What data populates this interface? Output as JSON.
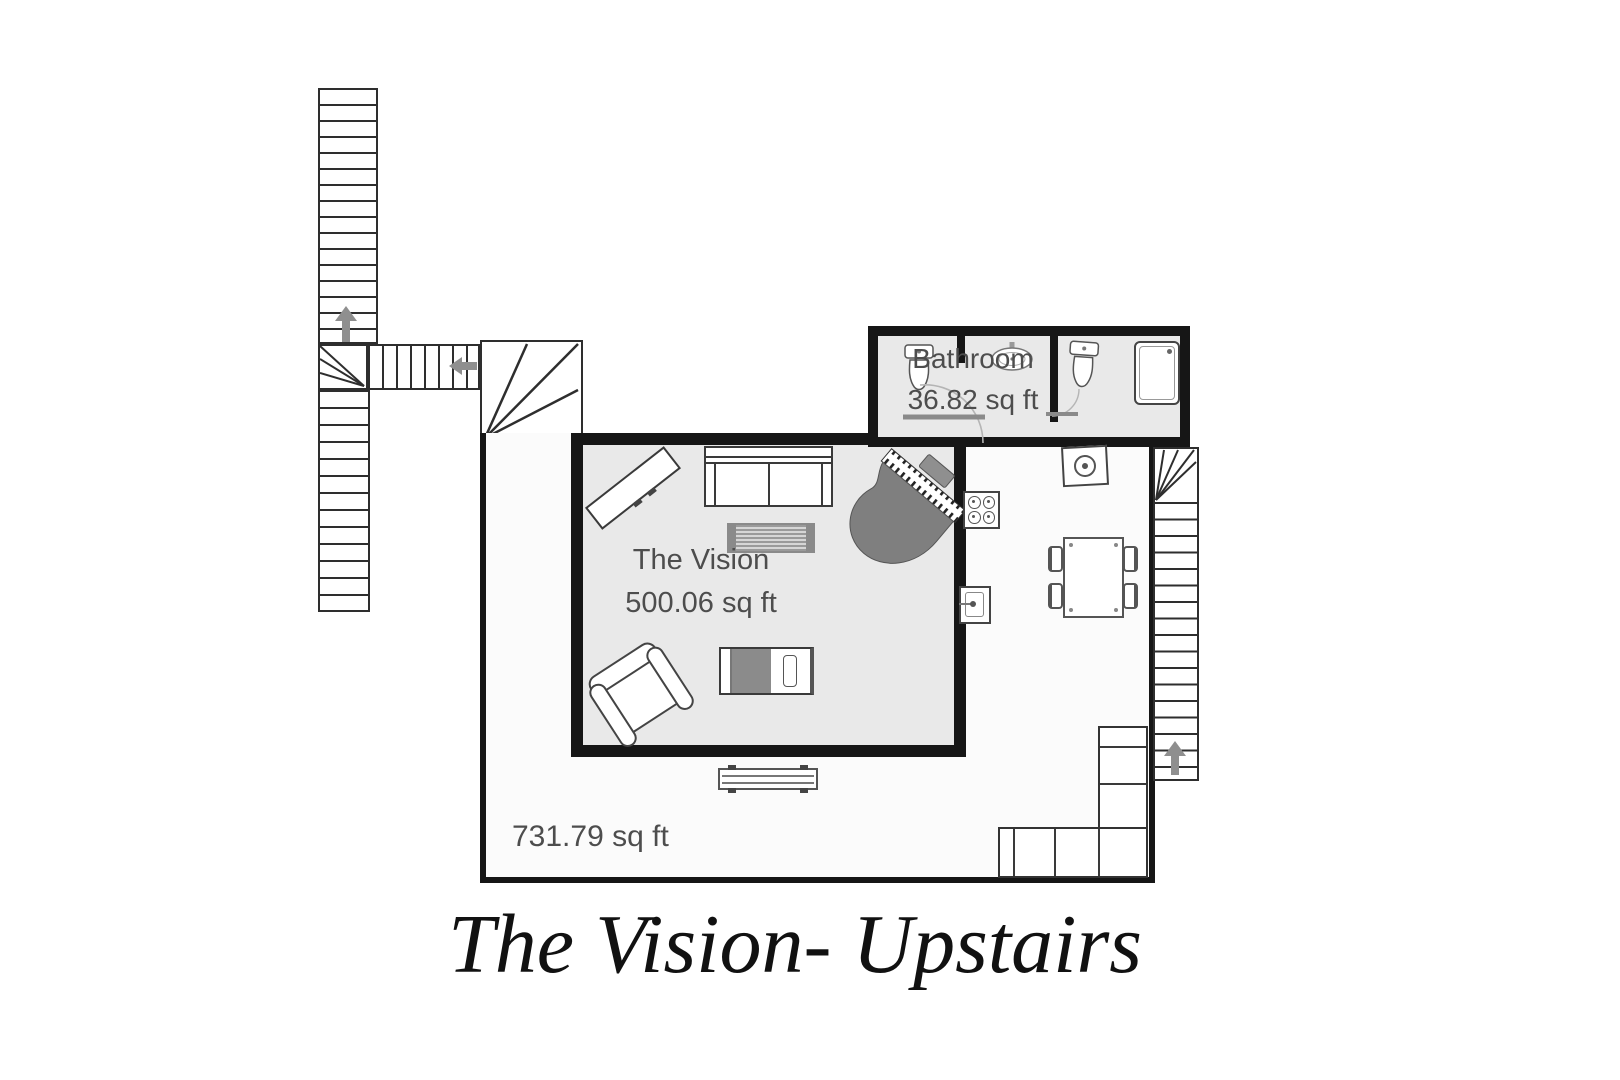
{
  "title": {
    "text": "The Vision- Upstairs"
  },
  "rooms": {
    "vision": {
      "name": "The Vision",
      "area": "500.06 sq ft"
    },
    "bathroom": {
      "name": "Bathroom",
      "area": "36.82 sq ft"
    },
    "open_area": {
      "area": "731.79 sq ft"
    }
  },
  "icons": {
    "stairs_up_arrow": "solid up-triangle with stem (css shape)",
    "stairs_left_arrow": "solid left-triangle with stem (css shape)"
  },
  "colors": {
    "wall": "#161616",
    "room_fill": "#e9e9e9",
    "open_area_fill": "#fbfbfb",
    "stair_line": "#2e2e2e",
    "furniture_gray": "#7f7f7f",
    "label_text": "#4d4d4d",
    "arrow_gray": "#8f8f8f",
    "title_text": "#111111"
  }
}
